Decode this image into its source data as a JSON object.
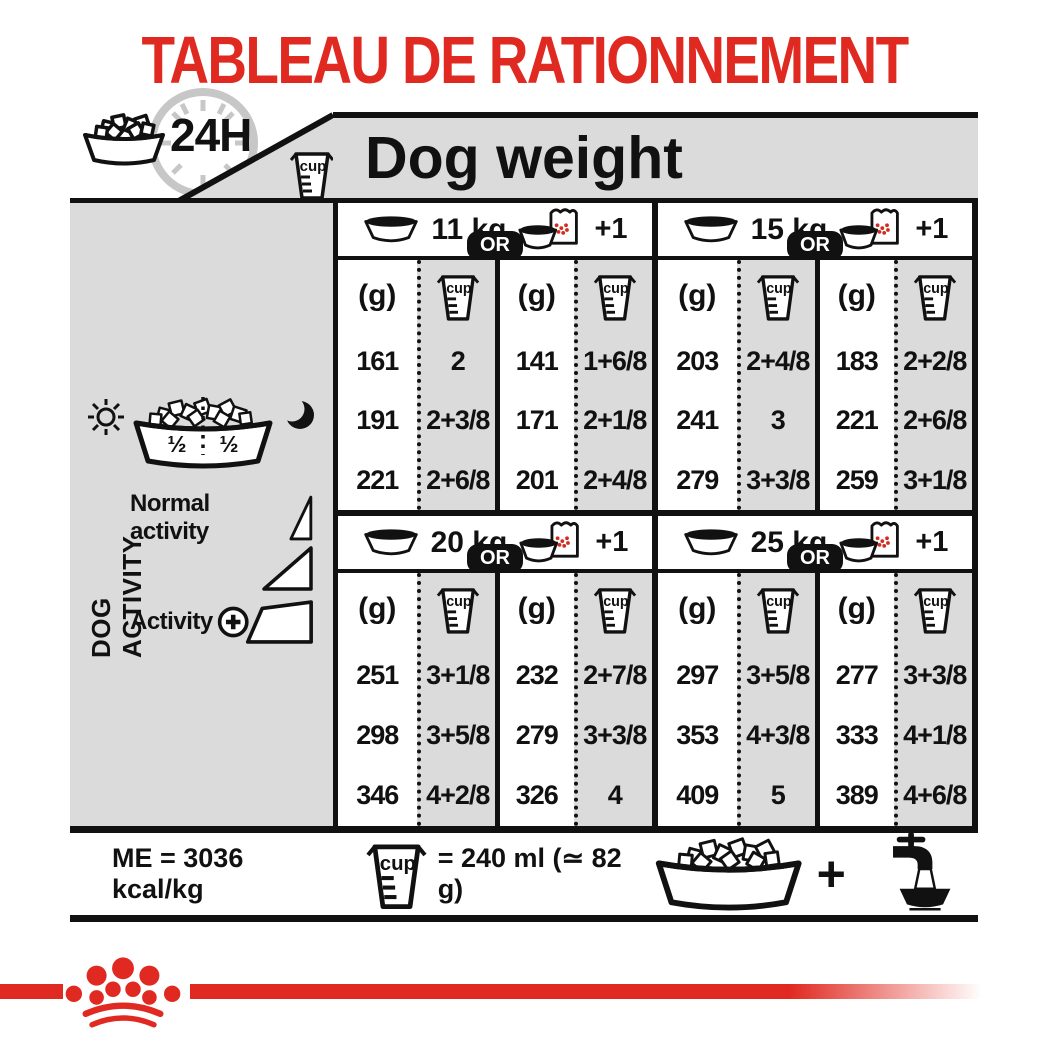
{
  "page": {
    "title": "TABLEAU DE RATIONNEMENT"
  },
  "header": {
    "duration_label": "24H",
    "table_title": "Dog weight",
    "cup_label": "cup"
  },
  "sidebar": {
    "axis_label": "DOG ACTIVITY",
    "half_left": "½",
    "half_right": "½",
    "normal_activity_label": "Normal activity",
    "activity_label": "Activity",
    "plus": "+"
  },
  "table": {
    "or_label": "OR",
    "plus_one_label": "+1",
    "grams_header": "(g)",
    "cup_label": "cup",
    "blocks": [
      {
        "weight": "11 kg",
        "rows": [
          [
            "161",
            "2",
            "141",
            "1+6/8"
          ],
          [
            "191",
            "2+3/8",
            "171",
            "2+1/8"
          ],
          [
            "221",
            "2+6/8",
            "201",
            "2+4/8"
          ]
        ]
      },
      {
        "weight": "15 kg",
        "rows": [
          [
            "203",
            "2+4/8",
            "183",
            "2+2/8"
          ],
          [
            "241",
            "3",
            "221",
            "2+6/8"
          ],
          [
            "279",
            "3+3/8",
            "259",
            "3+1/8"
          ]
        ]
      },
      {
        "weight": "20 kg",
        "rows": [
          [
            "251",
            "3+1/8",
            "232",
            "2+7/8"
          ],
          [
            "298",
            "3+5/8",
            "279",
            "3+3/8"
          ],
          [
            "346",
            "4+2/8",
            "326",
            "4"
          ]
        ]
      },
      {
        "weight": "25 kg",
        "rows": [
          [
            "297",
            "3+5/8",
            "277",
            "3+3/8"
          ],
          [
            "353",
            "4+3/8",
            "333",
            "4+1/8"
          ],
          [
            "409",
            "5",
            "389",
            "4+6/8"
          ]
        ]
      }
    ]
  },
  "footer": {
    "me_label": "ME = 3036 kcal/kg",
    "cup_label": "cup",
    "cup_equiv": "= 240 ml (≃ 82 g)",
    "plus": "+"
  },
  "colors": {
    "red": "#E02A21",
    "gray": "#DBDBDB",
    "ink": "#111111"
  }
}
